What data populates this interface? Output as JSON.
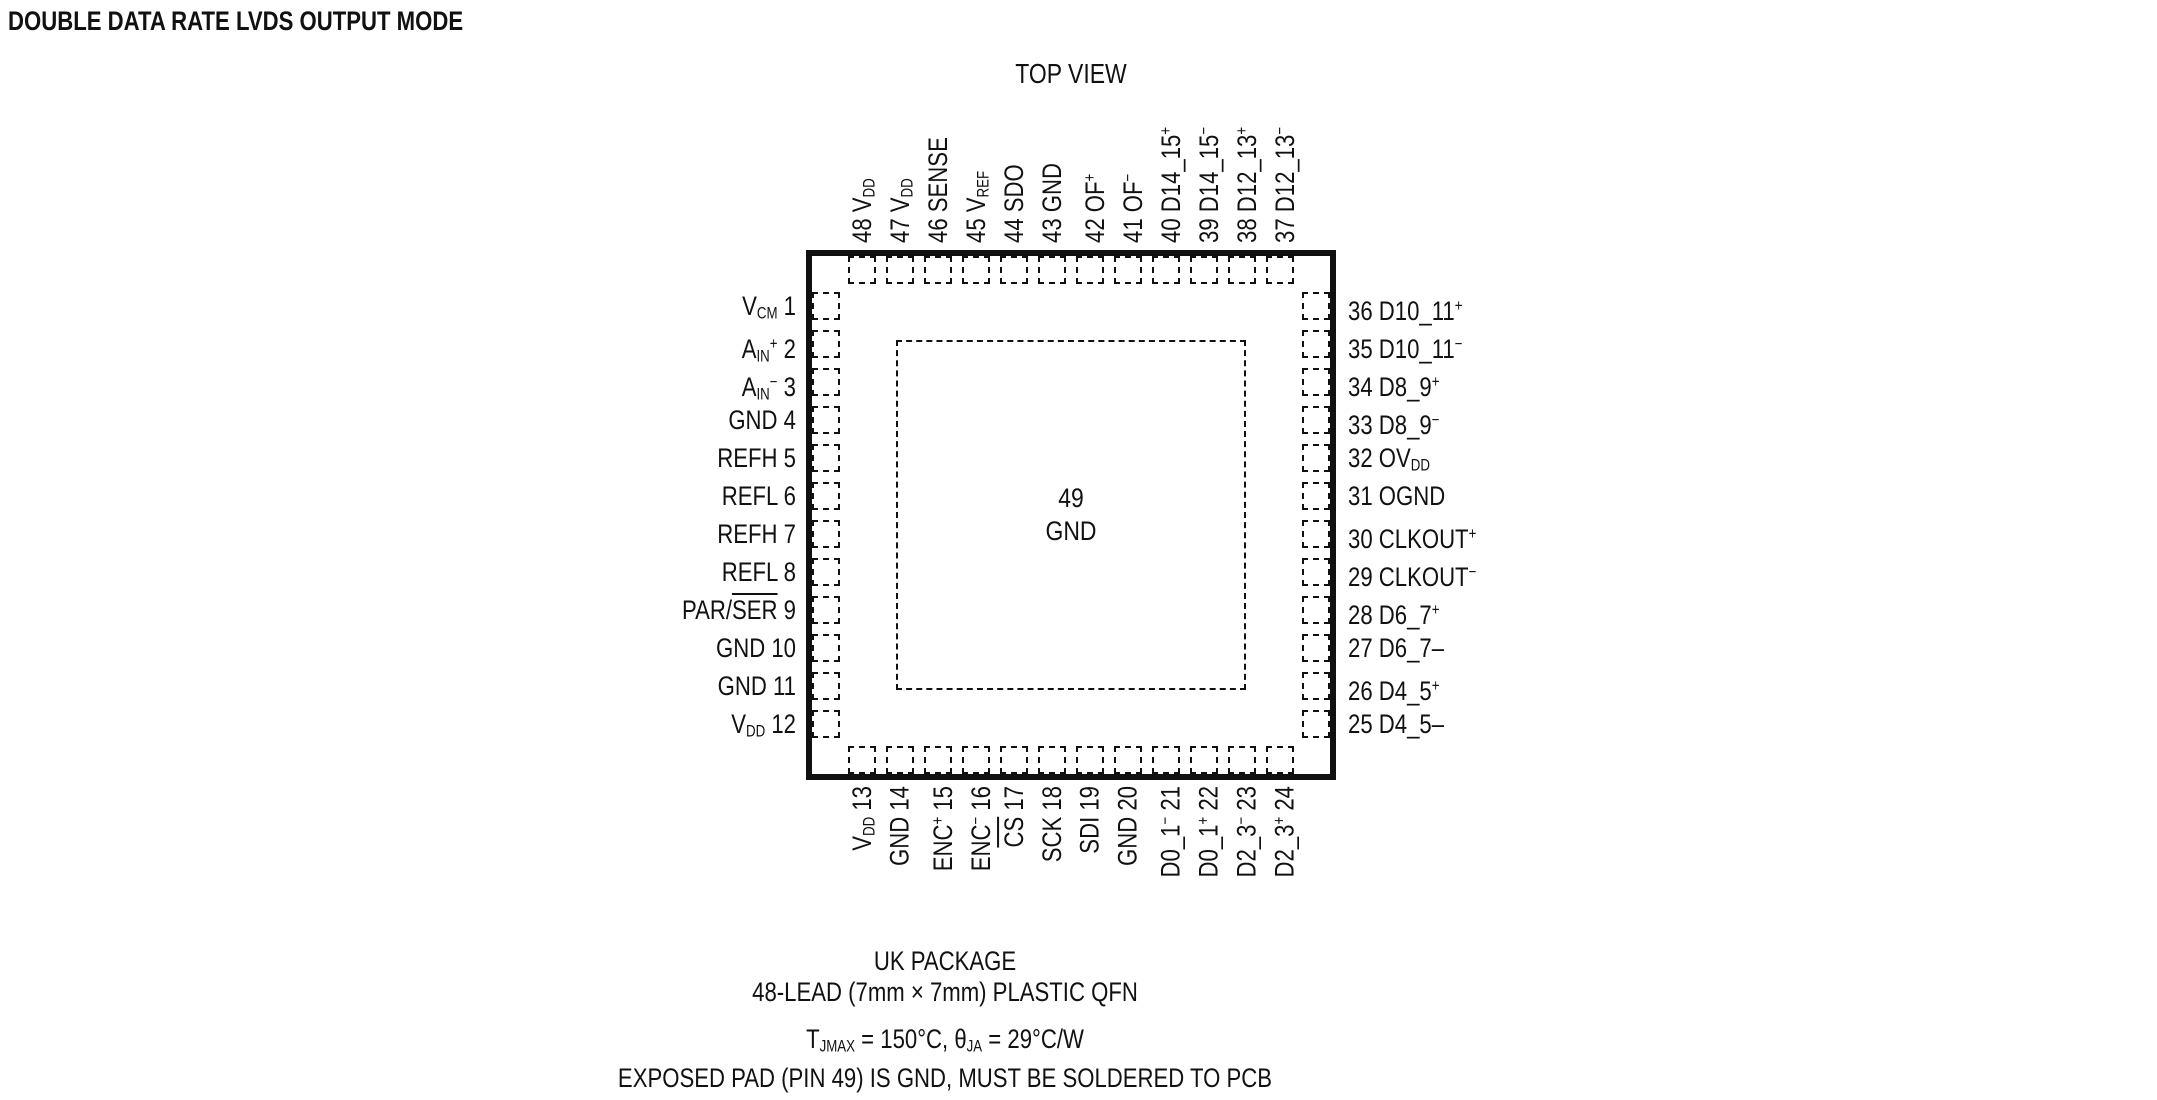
{
  "title": "DOUBLE DATA RATE LVDS OUTPUT MODE",
  "diagram": {
    "top_view_label": "TOP VIEW",
    "center_pad": {
      "number": "49",
      "name": "GND"
    },
    "pins": {
      "top": [
        {
          "num": 48,
          "parts": [
            {
              "s": "n",
              "t": "48 V"
            },
            {
              "s": "sub",
              "t": "DD"
            }
          ]
        },
        {
          "num": 47,
          "parts": [
            {
              "s": "n",
              "t": "47 V"
            },
            {
              "s": "sub",
              "t": "DD"
            }
          ]
        },
        {
          "num": 46,
          "parts": [
            {
              "s": "n",
              "t": "46 SENSE"
            }
          ]
        },
        {
          "num": 45,
          "parts": [
            {
              "s": "n",
              "t": "45 V"
            },
            {
              "s": "sub",
              "t": "REF"
            }
          ]
        },
        {
          "num": 44,
          "parts": [
            {
              "s": "n",
              "t": "44 SDO"
            }
          ]
        },
        {
          "num": 43,
          "parts": [
            {
              "s": "n",
              "t": "43 GND"
            }
          ]
        },
        {
          "num": 42,
          "parts": [
            {
              "s": "n",
              "t": "42 OF"
            },
            {
              "s": "sup",
              "t": "+"
            }
          ]
        },
        {
          "num": 41,
          "parts": [
            {
              "s": "n",
              "t": "41 OF"
            },
            {
              "s": "sup",
              "t": "−"
            }
          ]
        },
        {
          "num": 40,
          "parts": [
            {
              "s": "n",
              "t": "40 D14_15"
            },
            {
              "s": "sup",
              "t": "+"
            }
          ]
        },
        {
          "num": 39,
          "parts": [
            {
              "s": "n",
              "t": "39 D14_15"
            },
            {
              "s": "sup",
              "t": "−"
            }
          ]
        },
        {
          "num": 38,
          "parts": [
            {
              "s": "n",
              "t": "38 D12_13"
            },
            {
              "s": "sup",
              "t": "+"
            }
          ]
        },
        {
          "num": 37,
          "parts": [
            {
              "s": "n",
              "t": "37 D12_13"
            },
            {
              "s": "sup",
              "t": "−"
            }
          ]
        }
      ],
      "left": [
        {
          "num": 1,
          "parts": [
            {
              "s": "n",
              "t": "V"
            },
            {
              "s": "sub",
              "t": "CM"
            },
            {
              "s": "n",
              "t": " 1"
            }
          ]
        },
        {
          "num": 2,
          "parts": [
            {
              "s": "n",
              "t": "A"
            },
            {
              "s": "sub",
              "t": "IN"
            },
            {
              "s": "sup",
              "t": "+"
            },
            {
              "s": "n",
              "t": " 2"
            }
          ]
        },
        {
          "num": 3,
          "parts": [
            {
              "s": "n",
              "t": "A"
            },
            {
              "s": "sub",
              "t": "IN"
            },
            {
              "s": "sup",
              "t": "−"
            },
            {
              "s": "n",
              "t": " 3"
            }
          ]
        },
        {
          "num": 4,
          "parts": [
            {
              "s": "n",
              "t": "GND 4"
            }
          ]
        },
        {
          "num": 5,
          "parts": [
            {
              "s": "n",
              "t": "REFH 5"
            }
          ]
        },
        {
          "num": 6,
          "parts": [
            {
              "s": "n",
              "t": "REFL 6"
            }
          ]
        },
        {
          "num": 7,
          "parts": [
            {
              "s": "n",
              "t": "REFH 7"
            }
          ]
        },
        {
          "num": 8,
          "parts": [
            {
              "s": "n",
              "t": "REFL 8"
            }
          ]
        },
        {
          "num": 9,
          "parts": [
            {
              "s": "n",
              "t": "PAR/"
            },
            {
              "s": "over",
              "t": "SER"
            },
            {
              "s": "n",
              "t": " 9"
            }
          ]
        },
        {
          "num": 10,
          "parts": [
            {
              "s": "n",
              "t": "GND 10"
            }
          ]
        },
        {
          "num": 11,
          "parts": [
            {
              "s": "n",
              "t": "GND 11"
            }
          ]
        },
        {
          "num": 12,
          "parts": [
            {
              "s": "n",
              "t": "V"
            },
            {
              "s": "sub",
              "t": "DD"
            },
            {
              "s": "n",
              "t": " 12"
            }
          ]
        }
      ],
      "right": [
        {
          "num": 36,
          "parts": [
            {
              "s": "n",
              "t": "36 D10_11"
            },
            {
              "s": "sup",
              "t": "+"
            }
          ]
        },
        {
          "num": 35,
          "parts": [
            {
              "s": "n",
              "t": "35 D10_11"
            },
            {
              "s": "sup",
              "t": "−"
            }
          ]
        },
        {
          "num": 34,
          "parts": [
            {
              "s": "n",
              "t": "34 D8_9"
            },
            {
              "s": "sup",
              "t": "+"
            }
          ]
        },
        {
          "num": 33,
          "parts": [
            {
              "s": "n",
              "t": "33 D8_9"
            },
            {
              "s": "sup",
              "t": "−"
            }
          ]
        },
        {
          "num": 32,
          "parts": [
            {
              "s": "n",
              "t": "32 OV"
            },
            {
              "s": "sub",
              "t": "DD"
            }
          ]
        },
        {
          "num": 31,
          "parts": [
            {
              "s": "n",
              "t": "31 OGND"
            }
          ]
        },
        {
          "num": 30,
          "parts": [
            {
              "s": "n",
              "t": "30 CLKOUT"
            },
            {
              "s": "sup",
              "t": "+"
            }
          ]
        },
        {
          "num": 29,
          "parts": [
            {
              "s": "n",
              "t": "29 CLKOUT"
            },
            {
              "s": "sup",
              "t": "−"
            }
          ]
        },
        {
          "num": 28,
          "parts": [
            {
              "s": "n",
              "t": "28 D6_7"
            },
            {
              "s": "sup",
              "t": "+"
            }
          ]
        },
        {
          "num": 27,
          "parts": [
            {
              "s": "n",
              "t": "27 D6_7–"
            }
          ]
        },
        {
          "num": 26,
          "parts": [
            {
              "s": "n",
              "t": "26 D4_5"
            },
            {
              "s": "sup",
              "t": "+"
            }
          ]
        },
        {
          "num": 25,
          "parts": [
            {
              "s": "n",
              "t": "25 D4_5–"
            }
          ]
        }
      ],
      "bottom": [
        {
          "num": 13,
          "parts": [
            {
              "s": "n",
              "t": "V"
            },
            {
              "s": "sub",
              "t": "DD"
            },
            {
              "s": "n",
              "t": " 13"
            }
          ]
        },
        {
          "num": 14,
          "parts": [
            {
              "s": "n",
              "t": "GND 14"
            }
          ]
        },
        {
          "num": 15,
          "parts": [
            {
              "s": "n",
              "t": "ENC"
            },
            {
              "s": "sup",
              "t": "+"
            },
            {
              "s": "n",
              "t": " 15"
            }
          ]
        },
        {
          "num": 16,
          "parts": [
            {
              "s": "n",
              "t": "ENC"
            },
            {
              "s": "sup",
              "t": "−"
            },
            {
              "s": "n",
              "t": " 16"
            }
          ]
        },
        {
          "num": 17,
          "parts": [
            {
              "s": "over",
              "t": "CS"
            },
            {
              "s": "n",
              "t": " 17"
            }
          ]
        },
        {
          "num": 18,
          "parts": [
            {
              "s": "n",
              "t": "SCK 18"
            }
          ]
        },
        {
          "num": 19,
          "parts": [
            {
              "s": "n",
              "t": "SDI 19"
            }
          ]
        },
        {
          "num": 20,
          "parts": [
            {
              "s": "n",
              "t": "GND 20"
            }
          ]
        },
        {
          "num": 21,
          "parts": [
            {
              "s": "n",
              "t": "D0_1"
            },
            {
              "s": "sup",
              "t": "−"
            },
            {
              "s": "n",
              "t": " 21"
            }
          ]
        },
        {
          "num": 22,
          "parts": [
            {
              "s": "n",
              "t": "D0_1"
            },
            {
              "s": "sup",
              "t": "+"
            },
            {
              "s": "n",
              "t": " 22"
            }
          ]
        },
        {
          "num": 23,
          "parts": [
            {
              "s": "n",
              "t": "D2_3"
            },
            {
              "s": "sup",
              "t": "−"
            },
            {
              "s": "n",
              "t": " 23"
            }
          ]
        },
        {
          "num": 24,
          "parts": [
            {
              "s": "n",
              "t": "D2_3"
            },
            {
              "s": "sup",
              "t": "+"
            },
            {
              "s": "n",
              "t": " 24"
            }
          ]
        }
      ]
    }
  },
  "footer": {
    "line1": "UK PACKAGE",
    "line2": "48-LEAD (7mm × 7mm) PLASTIC QFN",
    "line3_parts": [
      {
        "s": "n",
        "t": "T"
      },
      {
        "s": "sub",
        "t": "JMAX"
      },
      {
        "s": "n",
        "t": " = 150°C, θ"
      },
      {
        "s": "sub",
        "t": "JA"
      },
      {
        "s": "n",
        "t": " = 29°C/W"
      }
    ],
    "line4": "EXPOSED PAD (PIN 49) IS GND, MUST BE SOLDERED TO PCB"
  },
  "colors": {
    "ink": "#111111",
    "background": "#ffffff"
  }
}
